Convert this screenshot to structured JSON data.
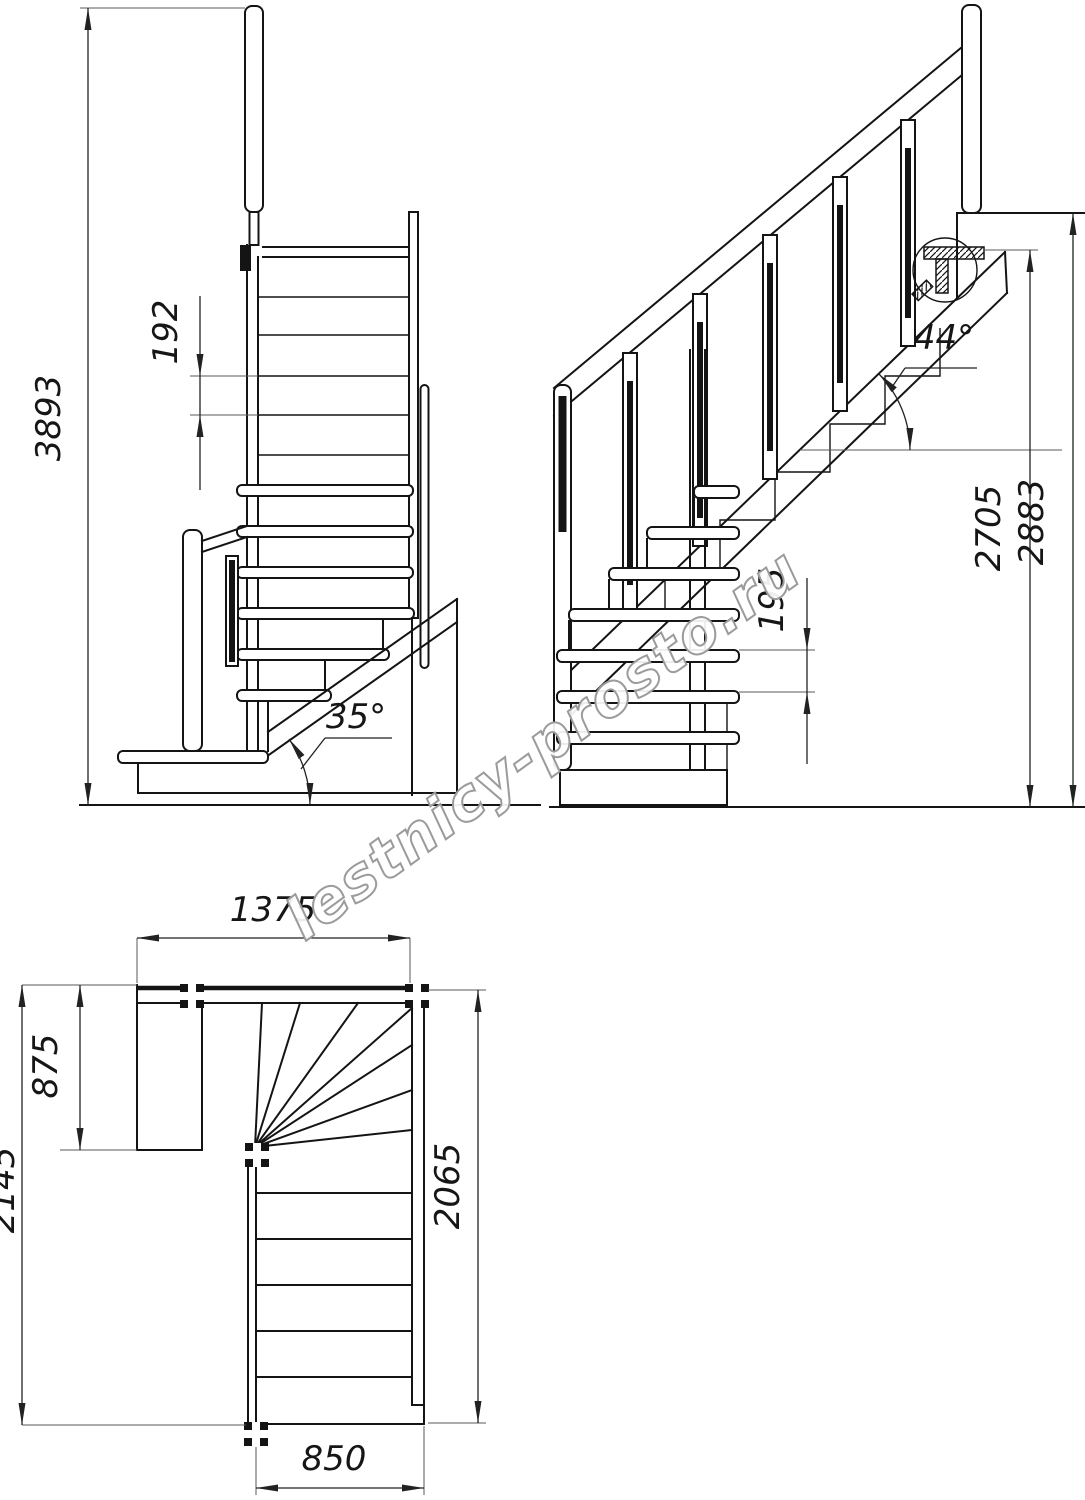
{
  "watermark": "lestnicy-prosto.ru",
  "colors": {
    "line": "#141414",
    "dimension": "#222222",
    "watermark_outline": "#9b9b9b",
    "background": "#ffffff"
  },
  "front_view": {
    "overall_height": "3893",
    "riser_spacing": "192",
    "stringer_angle": "35°"
  },
  "side_view": {
    "riser_spacing": "195",
    "height_to_stringer_top": "2705",
    "floor_to_floor_height": "2883",
    "stringer_angle": "44°"
  },
  "plan_view": {
    "upper_flight_width": "1375",
    "landing_depth": "875",
    "overall_depth": "2145",
    "lower_flight_length": "2065",
    "flight_width": "850"
  }
}
